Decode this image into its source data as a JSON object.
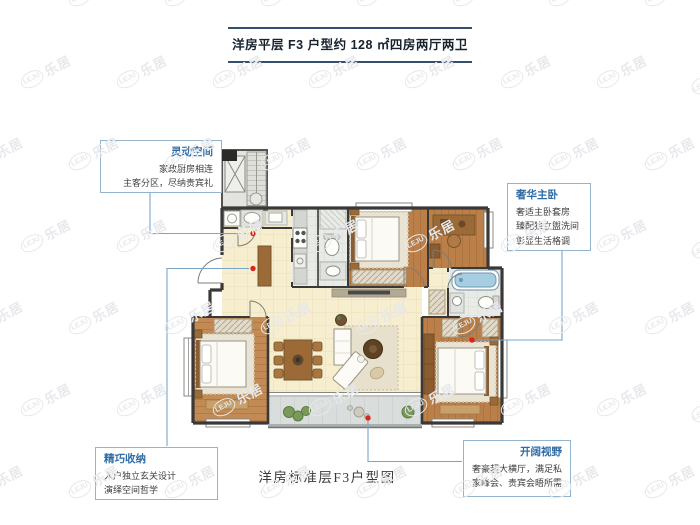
{
  "header": {
    "title": "洋房平层 F3 户型约 128 ㎡四房两厅两卫"
  },
  "footer": {
    "caption": "洋房标准层F3户型图"
  },
  "callouts": [
    {
      "title": "灵动空间",
      "lines": [
        "家政厨房相连",
        "主客分区，尽纳贵宾礼"
      ]
    },
    {
      "title": "奢华主卧",
      "lines": [
        "奢适主卧套房",
        "臻配独立盥洗间",
        "彰显生活格调"
      ]
    },
    {
      "title": "精巧收纳",
      "lines": [
        "入户独立玄关设计",
        "演绎空间哲学"
      ]
    },
    {
      "title": "开阔视野",
      "lines": [
        "奢豪超大横厅，满足私",
        "家峰会、贵宾会晤所需"
      ]
    }
  ],
  "watermark": {
    "logo": "LEJU",
    "text": "乐居"
  },
  "colors": {
    "callout_title_blue": "#2e6ca5",
    "callout_border_blue": "#94b4ce",
    "connector_blue": "#79a6c8",
    "marker_red": "#d8281e",
    "title_rule_navy": "#33516e",
    "wall_dark": "#3a3938",
    "wood_floor": "#bb7f49",
    "living_floor_beige": "#f6eecf",
    "bathtub_blue": "#a7cde2"
  }
}
